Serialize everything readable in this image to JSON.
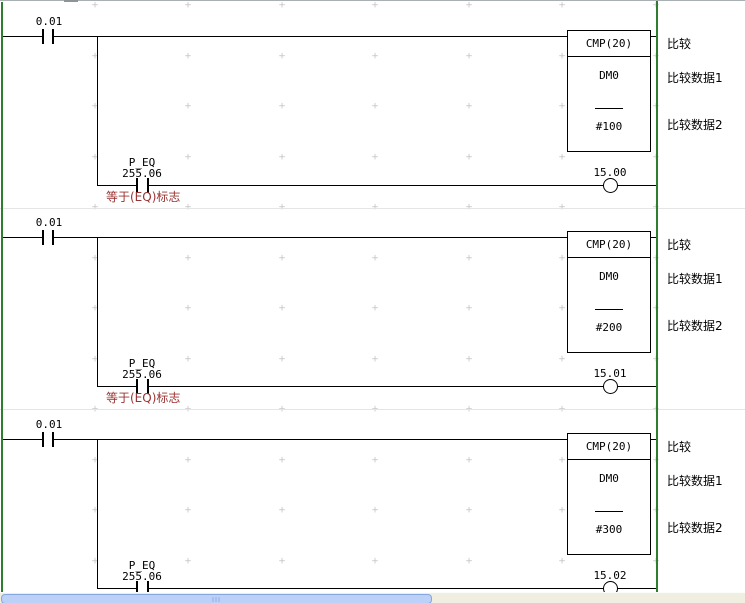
{
  "editor": {
    "kind": "plc-ladder-view"
  },
  "colors": {
    "bus_rail_green": "#2f7e2f",
    "wire_black": "#000000",
    "comment_red": "#9a3333",
    "separator_gray": "#e5e5e5",
    "grid_mark_gray": "#c3c3c3",
    "scrollbar_thumb_blue": "#bdd1f8",
    "scrollbar_track_beige": "#f0ede1"
  },
  "grid": {
    "glyph": "+",
    "xs": [
      95,
      188,
      282,
      375,
      469,
      562,
      656
    ],
    "ys": [
      6,
      57,
      107,
      158,
      208,
      259,
      309,
      360,
      410,
      461,
      511,
      562
    ]
  },
  "rungs": [
    {
      "input_contact": {
        "address": "0.01"
      },
      "block": {
        "mnemonic": "CMP(20)",
        "operand1": "DM0",
        "operand2": "#100"
      },
      "block_comments": {
        "title": "比较",
        "data1": "比较数据1",
        "data2": "比较数据2"
      },
      "eq_contact": {
        "name": "P_EQ",
        "address": "255.06",
        "comment": "等于(EQ)标志"
      },
      "coil": {
        "address": "15.00"
      }
    },
    {
      "input_contact": {
        "address": "0.01"
      },
      "block": {
        "mnemonic": "CMP(20)",
        "operand1": "DM0",
        "operand2": "#200"
      },
      "block_comments": {
        "title": "比较",
        "data1": "比较数据1",
        "data2": "比较数据2"
      },
      "eq_contact": {
        "name": "P_EQ",
        "address": "255.06",
        "comment": "等于(EQ)标志"
      },
      "coil": {
        "address": "15.01"
      }
    },
    {
      "input_contact": {
        "address": "0.01"
      },
      "block": {
        "mnemonic": "CMP(20)",
        "operand1": "DM0",
        "operand2": "#300"
      },
      "block_comments": {
        "title": "比较",
        "data1": "比较数据1",
        "data2": "比较数据2"
      },
      "eq_contact": {
        "name": "P_EQ",
        "address": "255.06"
      },
      "coil": {
        "address": "15.02"
      }
    }
  ]
}
